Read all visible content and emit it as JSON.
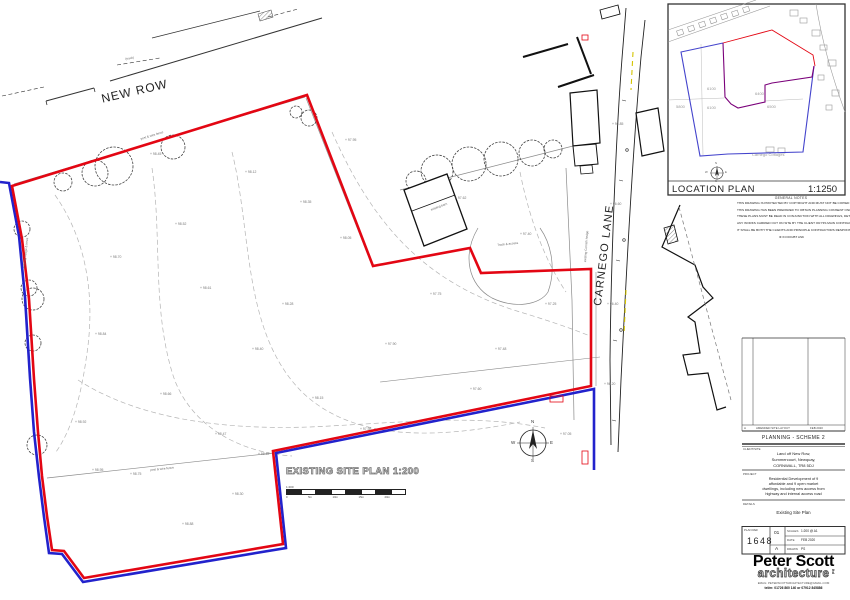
{
  "plan": {
    "new_row": "NEW ROW",
    "carnego": "CARNEGO LANE",
    "title": "EXISTING SITE PLAN 1:200",
    "scale_label": "1:200",
    "scale_ticks": [
      "0",
      "5m",
      "10m",
      "15m",
      "20m"
    ],
    "compass": {
      "n": "N",
      "e": "E",
      "s": "S",
      "w": "W"
    },
    "colors": {
      "site_boundary_red": "#e30613",
      "ownership_blue": "#2222cc"
    },
    "spot_levels": [
      {
        "x": 150,
        "y": 152,
        "v": "+ 98.45"
      },
      {
        "x": 245,
        "y": 170,
        "v": "+ 98.12"
      },
      {
        "x": 345,
        "y": 138,
        "v": "+ 97.95"
      },
      {
        "x": 300,
        "y": 200,
        "v": "+ 98.35"
      },
      {
        "x": 455,
        "y": 196,
        "v": "+ 97.62"
      },
      {
        "x": 175,
        "y": 222,
        "v": "+ 98.52"
      },
      {
        "x": 110,
        "y": 255,
        "v": "+ 98.70"
      },
      {
        "x": 340,
        "y": 236,
        "v": "+ 98.05"
      },
      {
        "x": 520,
        "y": 232,
        "v": "+ 97.40"
      },
      {
        "x": 200,
        "y": 286,
        "v": "+ 98.61"
      },
      {
        "x": 282,
        "y": 302,
        "v": "+ 98.28"
      },
      {
        "x": 430,
        "y": 292,
        "v": "+ 97.75"
      },
      {
        "x": 545,
        "y": 302,
        "v": "+ 97.25"
      },
      {
        "x": 95,
        "y": 332,
        "v": "+ 98.84"
      },
      {
        "x": 252,
        "y": 347,
        "v": "+ 98.40"
      },
      {
        "x": 385,
        "y": 342,
        "v": "+ 97.90"
      },
      {
        "x": 495,
        "y": 347,
        "v": "+ 97.48"
      },
      {
        "x": 160,
        "y": 392,
        "v": "+ 98.66"
      },
      {
        "x": 312,
        "y": 396,
        "v": "+ 98.15"
      },
      {
        "x": 470,
        "y": 387,
        "v": "+ 97.60"
      },
      {
        "x": 75,
        "y": 420,
        "v": "+ 98.92"
      },
      {
        "x": 215,
        "y": 432,
        "v": "+ 98.47"
      },
      {
        "x": 360,
        "y": 427,
        "v": "+ 97.98"
      },
      {
        "x": 130,
        "y": 472,
        "v": "+ 98.75"
      },
      {
        "x": 232,
        "y": 492,
        "v": "+ 98.30"
      },
      {
        "x": 612,
        "y": 122,
        "v": "+ 96.85"
      },
      {
        "x": 610,
        "y": 202,
        "v": "+ 96.60"
      },
      {
        "x": 607,
        "y": 302,
        "v": "+ 96.40"
      },
      {
        "x": 604,
        "y": 382,
        "v": "+ 96.20"
      },
      {
        "x": 560,
        "y": 432,
        "v": "+ 97.05"
      },
      {
        "x": 182,
        "y": 522,
        "v": "+ 98.88"
      },
      {
        "x": 92,
        "y": 468,
        "v": "+ 98.95"
      },
      {
        "x": 258,
        "y": 452,
        "v": "+ 98.62"
      }
    ],
    "small_labels": [
      {
        "x": 125,
        "y": 57,
        "rot": -10,
        "v": "(track)"
      },
      {
        "x": 140,
        "y": 137,
        "rot": -17,
        "v": "post & wire fence"
      },
      {
        "x": 497,
        "y": 243,
        "rot": -6,
        "v": "Track & access"
      },
      {
        "x": 583,
        "y": 262,
        "rot": -86,
        "v": "existing Cornish hedge"
      },
      {
        "x": 22,
        "y": 268,
        "rot": -84,
        "v": "existing hedge & trees"
      },
      {
        "x": 150,
        "y": 468,
        "rot": -6,
        "v": "post & wire fence"
      },
      {
        "x": 430,
        "y": 208,
        "rot": -21,
        "v": "existing barn"
      }
    ]
  },
  "location_plan": {
    "title": "LOCATION PLAN",
    "scale": "1:1250",
    "general_notes_header": "GENERAL NOTES",
    "compass": {
      "n": "N",
      "e": "E",
      "s": "S",
      "w": "W"
    },
    "parcels": [
      {
        "x": 676,
        "y": 104,
        "v": "5800"
      },
      {
        "x": 707,
        "y": 86,
        "v": "6100"
      },
      {
        "x": 707,
        "y": 105,
        "v": "6100"
      },
      {
        "x": 755,
        "y": 91,
        "v": "6400"
      },
      {
        "x": 767,
        "y": 104,
        "v": "6500"
      },
      {
        "x": 752,
        "y": 152,
        "v": "Carnego Cottages"
      }
    ]
  },
  "notes": {
    "paragraphs": [
      "THIS DRAWING IS PROTECTED BY COPYRIGHT AND MUST NOT BE COPIED WITHOUT THE PRIOR PERMISSION OF PETER SCOTT ARCHITECTURE LIMITED.",
      "THIS DRAWING HAS BEEN PREPARED TO OBTAIN PLANNING CONSENT ONLY, THEREFORE THESE PLANS SHOULD NOT BE USED FOR CONSTRUCTIONAL PURPOSES.",
      "THESE PLANS MUST BE READ IN CONJUNCTION WITH ALL DRAWINGS, DETAILS, CALCULATIONS & SPECIFICATIONS ISSUED FOR CONSTRUCTIONAL PURPOSES BY PETER SCOTT ARCHITECTURE LIMITED, THE STRUCTURAL ENGINEER AND ALL RELEVANT SUPPLIERS AND MANUFACTURERS.",
      "ANY WORKS CARRIED OUT ON SITE BY THE CLIENT OR HIS MAIN CONTRACTORS PRIOR TO APPROVAL OR THE SUBMISSION OF ANY ADDITIONAL INFORMATION OR DETAILS OR SAMPLES OR CALCULATIONS OR REPORTS REQUESTED BY THE PLANNING DEPARTMENT IN ANY CONDITIONAL APPROVAL IS CARRIED OUT ENTIRELY AT THEIR OWN RISK.",
      "IT SHALL BE BOTH THE CLIENTS AND PRINCIPLE CONTRACTORS RESPONSIBILITY TO EMPLOY A FULLY QUALIFIED CDM COORDINATOR OR ALTERNATIVELY NOTIFY HSE TO ENSURE THE REQUIREMENTS OF THE CURRENT LEGISLATION COVERED BY THE CONSTRUCTION DESIGN AND MANAGEMENT REGULATIONS 2015 & THE HEALTH AND SAFETY AT WORK ACT AS WELL AS THE MANAGEMENT OF HEALTH AND SAFETY AT WORK ACT ARE COMPLIED WITH BY ALL SITE STAKEHOLDERS DURING THE VARIOUS STAGES OF THE DESIGN AND CONSTRUCTION WORKS."
    ],
    "footer": "IF IN DOUBT ASK"
  },
  "titleblock": {
    "revision": {
      "rev": "A",
      "desc": "AMENDED SITE LAYOUT",
      "date": "FEB 2020"
    },
    "stage": "PLANNING - SCHEME 2",
    "client_label": "CLIENT/SITE",
    "client_lines": [
      "Land off New Row,",
      "Summercourt, Newquay,",
      "CORNWALL, TR8 5DJ"
    ],
    "project_label": "PROJECT",
    "project_lines": [
      "Residential Development of 9",
      "affordable and 9 open market",
      "dwellings, including new access from",
      "highway and internal access road"
    ],
    "details_label": "DETAILS",
    "details_value": "Existing Site Plan",
    "plan_ref_label": "PLAN REF",
    "plan_ref": "1648",
    "issue": "01",
    "rev_letter": "A",
    "scales_label": "SCALES",
    "scales": "1:200 @ A1",
    "date_label": "DATE",
    "date": "FEB 2020",
    "drawn_label": "DRAWN",
    "drawn": "PS",
    "logo_line1": "Peter Scott",
    "logo_line2": "architecture",
    "logo_suffix": "ltd",
    "contact_line1": "EMAIL: PETERSCOTTARCHITECTURE@GMAIL.COM",
    "contact_line2": "tel/m: 01726 860 140 or 07912 845886"
  }
}
